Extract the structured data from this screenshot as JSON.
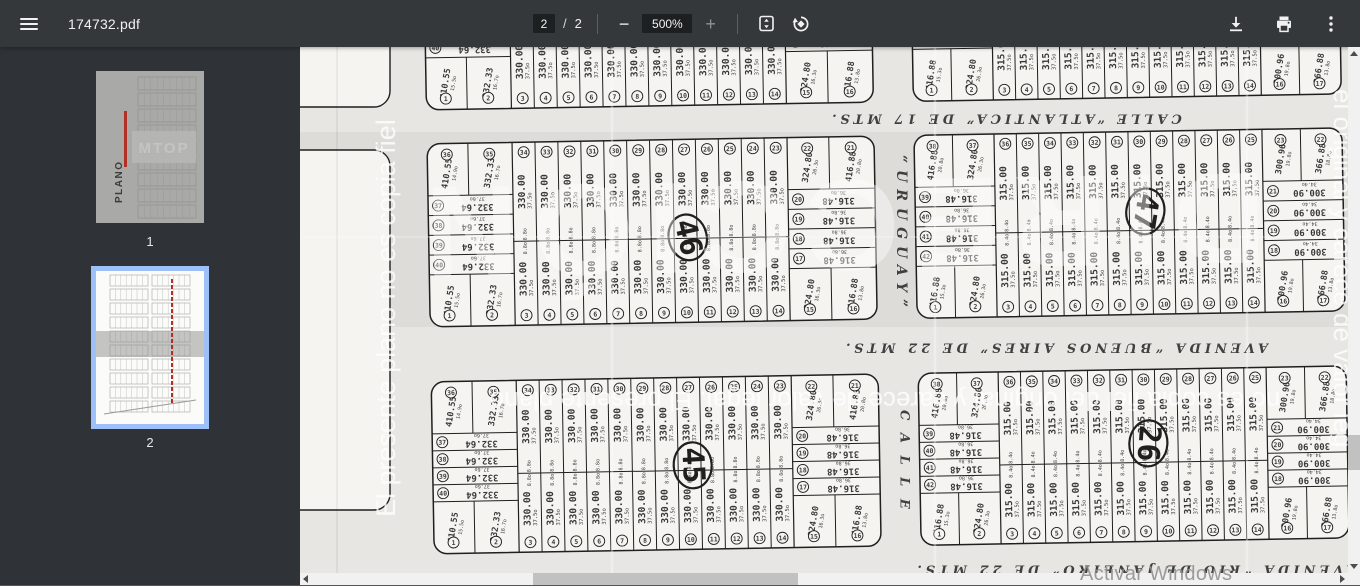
{
  "colors": {
    "toolbar_bg": "#35383b",
    "sidebar_bg": "#2f3337",
    "field_bg": "#1d2021",
    "accent": "#9cc0f7",
    "scroll_track": "#f1f1f1",
    "scroll_thumb": "#c1c1c1",
    "thumbnail_red": "#b03028",
    "activar_gray": "#8c8c8c"
  },
  "toolbar": {
    "title": "174732.pdf",
    "page_current": "2",
    "page_separator": "/",
    "page_total": "2",
    "zoom_out_label": "−",
    "zoom_level": "500%",
    "zoom_in_label": "+"
  },
  "sidebar": {
    "thumb1_title": "PLANO",
    "thumb1_watermark": "MTOP",
    "thumbnails": [
      {
        "page_label": "1",
        "selected": false
      },
      {
        "page_label": "2",
        "selected": true
      }
    ]
  },
  "viewer": {
    "ink": "#1f1f1f",
    "paper": "#f5f4f1",
    "street": "#e7e6e3",
    "folds": [
      312,
      635,
      947
    ],
    "empty_blocks": [
      {
        "x": -110,
        "y": -60,
        "w": 200,
        "h": 120
      },
      {
        "x": -110,
        "y": 103,
        "w": 200,
        "h": 360
      }
    ],
    "streets": [
      {
        "label": "CALLE  “ATLANTICA”  DE  17 MTS.",
        "x": 705,
        "y": 71,
        "rot": 180,
        "size": 13,
        "ls": 4
      },
      {
        "label": "“URUGUAY”",
        "x": 601,
        "y": 108,
        "rot": 90,
        "size": 14,
        "ls": 7
      },
      {
        "label": "AVENIDA  “BUENOS AIRES”  DE  22 MTS.",
        "x": 755,
        "y": 300,
        "rot": 180,
        "size": 13,
        "ls": 4
      },
      {
        "label": "C A L L E",
        "x": 604,
        "y": 363,
        "rot": 90,
        "size": 13,
        "ls": 4
      },
      {
        "label": "AVENIDA  “RIO DE JANEIRO”  DE  22 MTS.",
        "x": 835,
        "y": 522,
        "rot": 180,
        "size": 13,
        "ls": 4
      }
    ],
    "watermarks": {
      "left_vertical": "El presente plano no es copia fiel",
      "bottom_inverted": "no es copia fiel del original y carece de valor legal. El presente plano",
      "right_vertical": "el original y carece de valor leg",
      "giant": "DIRECCIÓN"
    },
    "block_templates": {
      "A": {
        "w": 447,
        "left_w": 85,
        "right_w": 87,
        "left": {
          "top": [
            {
              "v": "410.55",
              "n": 36,
              "sub": "14.9o"
            },
            {
              "v": "332.33",
              "n": 35,
              "sub": "16.7o"
            }
          ],
          "stack": {
            "v": "332.64",
            "sub": "37.6o",
            "ns": [
              37,
              38,
              39,
              40
            ]
          },
          "bottom": [
            {
              "v": "410.55",
              "n": 1,
              "sub": "15.5o"
            },
            {
              "v": "332.33",
              "n": 2,
              "sub": "16.7o"
            }
          ]
        },
        "strips": {
          "v": "330.00",
          "sub": "37.5o",
          "edge": "8.8o",
          "n": 12,
          "top_start": 34,
          "top_step": -1,
          "bot_start": 3,
          "bot_step": 1
        },
        "right": {
          "top": [
            {
              "v": "324.80",
              "n": 22,
              "sub": "26.3o"
            },
            {
              "v": "416.88",
              "n": 21,
              "sub": "20.8o"
            }
          ],
          "stack": {
            "v": "316.48",
            "sub": "36.8o",
            "ns": [
              20,
              19,
              18,
              17
            ]
          },
          "bottom": [
            {
              "v": "324.80",
              "n": 15,
              "sub": "16.3o"
            },
            {
              "v": "416.88",
              "n": 16,
              "sub": "13.8o"
            }
          ]
        }
      },
      "B": {
        "w": 428,
        "left_w": 80,
        "right_w": 80,
        "left": {
          "top": [
            {
              "v": "416.88",
              "n": 38,
              "sub": "20.8o"
            },
            {
              "v": "324.80",
              "n": 37,
              "sub": "26.3o"
            }
          ],
          "stack": {
            "v": "316.48",
            "sub": "36.8o",
            "ns": [
              39,
              40,
              41,
              42
            ]
          },
          "bottom": [
            {
              "v": "416.88",
              "n": 1,
              "sub": "15.3o"
            },
            {
              "v": "324.80",
              "n": 2,
              "sub": "26.3o"
            }
          ]
        },
        "strips": {
          "v": "315.00",
          "sub": "37.5o",
          "edge": "8.4o",
          "n": 12,
          "top_start": 36,
          "top_step": -1,
          "bot_start": 3,
          "bot_step": 1
        },
        "right": {
          "top": [
            {
              "v": "300.96",
              "n": 23,
              "sub": "19.8o"
            },
            {
              "v": "366.88",
              "n": 22,
              "sub": "18.8o"
            }
          ],
          "stack": {
            "v": "300.90",
            "sub": "34.4o",
            "ns": [
              21,
              20,
              19,
              18
            ]
          },
          "bottom": [
            {
              "v": "300.96",
              "n": 16,
              "sub": "19.8o"
            },
            {
              "v": "366.88",
              "n": 17,
              "sub": "13.8o"
            }
          ]
        }
      }
    },
    "blocks": [
      {
        "template": "A",
        "x": 130,
        "y": -127,
        "h": 183
      },
      {
        "template": "B",
        "x": 617,
        "y": -127,
        "h": 183
      },
      {
        "template": "A",
        "x": 130,
        "y": 90,
        "h": 183,
        "big": {
          "s": "46",
          "x": 259,
          "y": 98,
          "r": 78
        }
      },
      {
        "template": "B",
        "x": 617,
        "y": 90,
        "h": 183,
        "big": {
          "s": "47",
          "x": 230,
          "y": 80,
          "r": 100
        }
      },
      {
        "template": "A",
        "x": 130,
        "y": 328,
        "h": 172,
        "big": {
          "s": "45",
          "x": 260,
          "y": 88,
          "r": 88
        }
      },
      {
        "template": "B",
        "x": 617,
        "y": 328,
        "h": 172,
        "big": {
          "s": "26",
          "x": 229,
          "y": 74,
          "r": 95
        }
      }
    ]
  },
  "os_watermark": {
    "text": "Activar Windows"
  }
}
